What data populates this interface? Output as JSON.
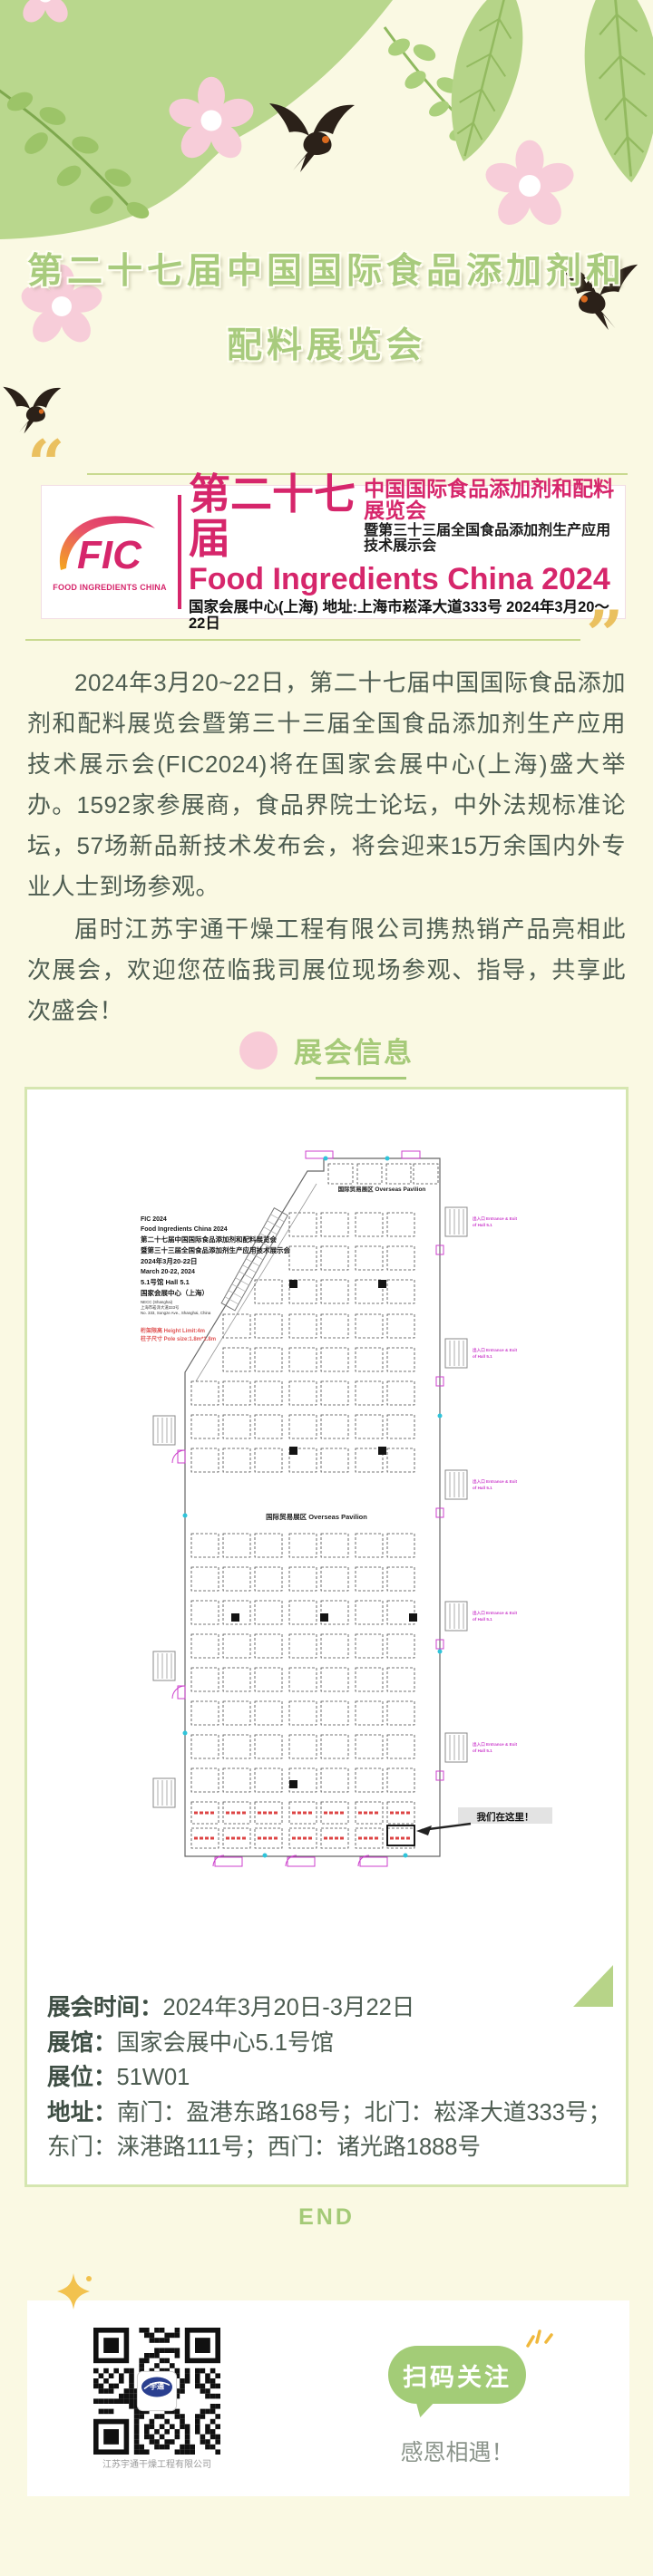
{
  "header": {
    "title_line1": "第二十七届中国国际食品添加剂和",
    "title_line2": "配料展览会"
  },
  "banner": {
    "logo_text": "FIC",
    "logo_sub": "FOOD INGREDIENTS CHINA",
    "cn_title": "第二十七届",
    "cn_line1": "中国国际食品添加剂和配料展览会",
    "cn_line2": "暨第三十三届全国食品添加剂生产应用技术展示会",
    "en_title": "Food Ingredients China 2024",
    "venue_line": "国家会展中心(上海) 地址:上海市崧泽大道333号 2024年3月20～22日"
  },
  "intro": {
    "p1": "2024年3月20~22日，第二十七届中国国际食品添加剂和配料展览会暨第三十三届全国食品添加剂生产应用技术展示会(FIC2024)将在国家会展中心(上海)盛大举办。1592家参展商，食品界院士论坛，中外法规标准论坛，57场新品新技术发布会，将会迎来15万余国内外专业人士到场参观。",
    "p2": "届时江苏宇通干燥工程有限公司携热销产品亮相此次展会，欢迎您莅临我司展位现场参观、指导，共享此次盛会！"
  },
  "section": {
    "title": "展会信息"
  },
  "floorplan": {
    "info_lines": [
      "FIC 2024",
      "Food Ingredients China 2024",
      "第二十七届中国国际食品添加剂和配料展览会",
      "暨第三十三届全国食品添加剂生产应用技术展示会",
      "2024年3月20-22日",
      "March 20-22, 2024",
      "5.1号馆  Hall 5.1",
      "国家会展中心（上海）",
      "NECC (Shanghai)",
      "上海市崧泽大道333号",
      "No. 333, Songze Ave., Shanghai, China"
    ],
    "height_limit": "桁架限高 Height Limit:4m",
    "pole_size": "柱子尺寸 Pole size:1.8m*1.8m",
    "pavilion_top": "国际贸易展区  Overseas Pavilion",
    "pavilion_mid": "国际贸易展区  Overseas Pavilion",
    "here_label": "我们在这里！",
    "entrance_label_1": "出入口 Entrance & Exit",
    "entrance_label_2": "of Hall 5.1"
  },
  "details": {
    "rows": [
      {
        "label": "展会时间：",
        "value": "2024年3月20日-3月22日"
      },
      {
        "label": "展馆：",
        "value": "国家会展中心5.1号馆"
      },
      {
        "label": "展位：",
        "value": "51W01"
      },
      {
        "label": "地址：",
        "value": "南门：盈港东路168号；北门：崧泽大道333号；东门：涞港路111号；西门：诸光路1888号"
      }
    ]
  },
  "end_label": "END",
  "footer": {
    "button_label": "扫码关注",
    "thanks": "感恩相遇！",
    "qr_caption": "江苏宇通干燥工程有限公司",
    "qr_logo_text": "宇通"
  },
  "colors": {
    "page_bg": "#faf9e3",
    "title_green": "#a8cb7d",
    "banner_pink": "#d6266b",
    "plan_magenta": "#cc3fcc",
    "bubble_green": "#a3cc77",
    "gold": "#eac05f",
    "flower_pink": "#f7cdd9"
  }
}
